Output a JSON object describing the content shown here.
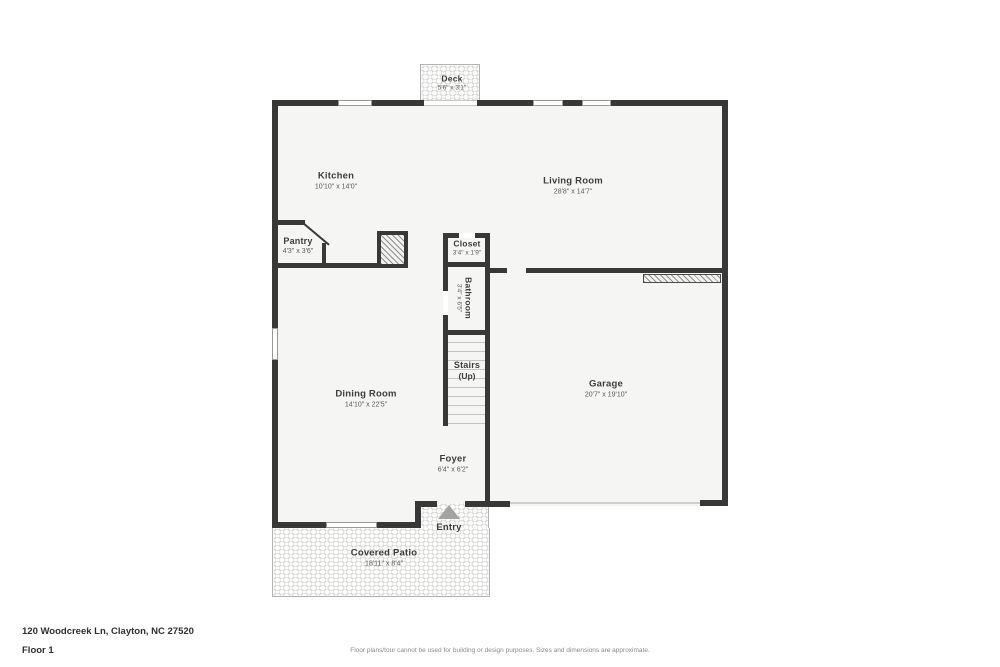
{
  "address_line": "120 Woodcreek Ln, Clayton, NC 27520",
  "floor_label": "Floor 1",
  "disclaimer": "Floor plans/tour cannot be used for building or design purposes. Sizes and dimensions are approximate.",
  "rooms": {
    "deck": {
      "name": "Deck",
      "dims": "5'6\" x 3'1\""
    },
    "kitchen": {
      "name": "Kitchen",
      "dims": "10'10\" x 14'0\""
    },
    "living_room": {
      "name": "Living Room",
      "dims": "28'8\" x 14'7\""
    },
    "pantry": {
      "name": "Pantry",
      "dims": "4'3\" x 3'6\""
    },
    "closet": {
      "name": "Closet",
      "dims": "3'4\" x 1'9\""
    },
    "bathroom": {
      "name": "Bathroom",
      "dims": "3'4\" x 6'5\""
    },
    "stairs": {
      "name": "Stairs",
      "dims": "(Up)"
    },
    "dining_room": {
      "name": "Dining Room",
      "dims": "14'10\" x 22'5\""
    },
    "garage": {
      "name": "Garage",
      "dims": "20'7\" x 19'10\""
    },
    "foyer": {
      "name": "Foyer",
      "dims": "6'4\" x 6'2\""
    },
    "entry": {
      "name": "Entry"
    },
    "covered_patio": {
      "name": "Covered Patio",
      "dims": "18'11\" x 8'4\""
    }
  },
  "colors": {
    "wall": "#383838",
    "floor": "#f5f5f4",
    "texture_dot": "#d6d6d6",
    "entry_arrow": "#a3a3a3",
    "room_name_text": "#3d3d3d",
    "dims_text": "#5a5a5a",
    "disclaimer_text": "#8a8a8a",
    "garage_door_line": "#cfcfcf"
  },
  "icons": {
    "entry_arrow": "up-triangle"
  }
}
